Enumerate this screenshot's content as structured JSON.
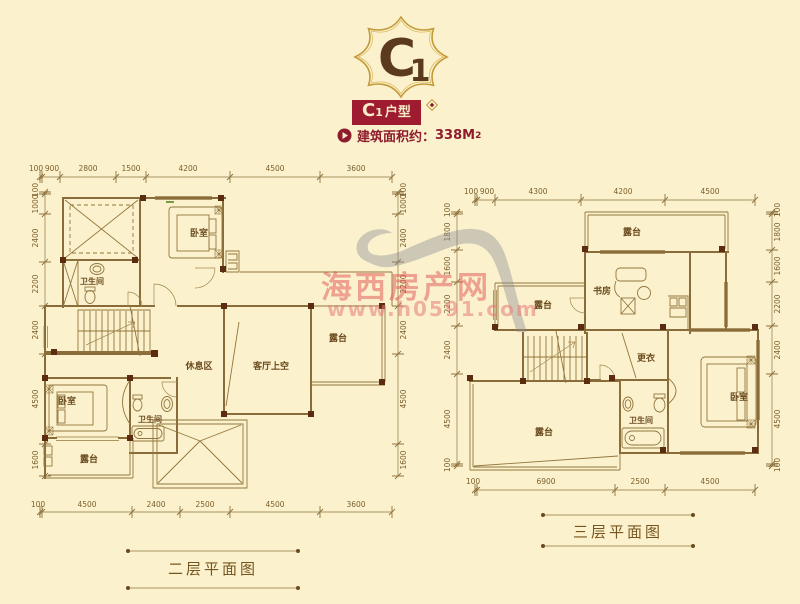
{
  "header": {
    "logo": {
      "letter": "C",
      "digit": "1"
    },
    "badge": {
      "letter": "C",
      "digit": "1",
      "suffix": "户型"
    },
    "area": {
      "label": "建筑面积约：",
      "value": "338M",
      "sup": "2"
    }
  },
  "watermark": {
    "line1": "海西房产网",
    "line2": "www.h0591.com"
  },
  "floor2": {
    "title": "二层平面图",
    "dims_top": [
      "100",
      "900",
      "2800",
      "1500",
      "4200",
      "4500",
      "3600"
    ],
    "dims_bottom": [
      "100",
      "4500",
      "2400",
      "2500",
      "4500",
      "3600"
    ],
    "dims_left": [
      "100",
      "1000",
      "2400",
      "2200",
      "2400",
      "4500",
      "1600"
    ],
    "dims_right": [
      "100",
      "1000",
      "2400",
      "2200",
      "2400",
      "4500",
      "1600"
    ],
    "rooms": {
      "bath_top": "卫生间",
      "bedroom_top": "卧室",
      "lounge": "休息区",
      "living_void": "客厅上空",
      "terrace_right": "露台",
      "bedroom_lower": "卧室",
      "bath_lower": "卫生间",
      "terrace_lower": "露台"
    }
  },
  "floor3": {
    "title": "三层平面图",
    "dims_top": [
      "100",
      "900",
      "4300",
      "4200",
      "4500"
    ],
    "dims_bottom": [
      "100",
      "6900",
      "2500",
      "4500"
    ],
    "dims_left": [
      "100",
      "1800",
      "1600",
      "2200",
      "2400",
      "4500",
      "100"
    ],
    "dims_right": [
      "100",
      "1800",
      "1600",
      "2200",
      "2400",
      "4500",
      "100"
    ],
    "rooms": {
      "terrace_top": "露台",
      "study": "书房",
      "terrace_left": "露台",
      "dressing": "更衣",
      "bedroom": "卧室",
      "bath": "卫生间",
      "terrace_big": "露台"
    }
  },
  "colors": {
    "background": "#fbf2cd",
    "plan_line": "#8a6c3a",
    "column": "#5b2c10",
    "accent_red": "#9e1b30",
    "gold": "#c49a3c",
    "watermark_red": "#e05858"
  }
}
